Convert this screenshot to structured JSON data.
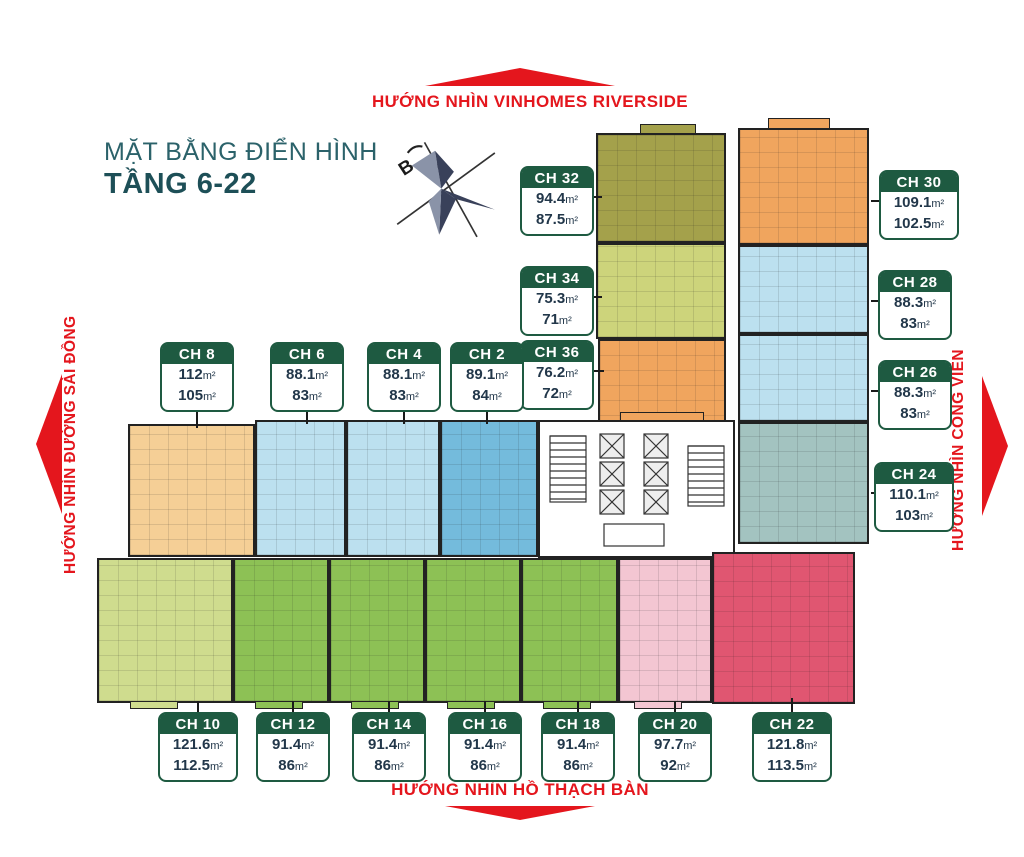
{
  "page": {
    "title_line1": "MẶT BẰNG ĐIỂN HÌNH",
    "title_line2": "TẦNG 6-22"
  },
  "directions": {
    "top": "HƯỚNG NHÌN VINHOMES RIVERSIDE",
    "bottom": "HƯỚNG NHÌN HỒ THẠCH BÀN",
    "left": "HƯỚNG NHÌN ĐƯỜNG SÀI ĐỒNG",
    "right": "HƯỚNG NHÌN CÔNG VIÊN"
  },
  "compass": {
    "label": "B"
  },
  "area_suffix": "m²",
  "units": [
    {
      "id": "ch-32",
      "label": "CH 32",
      "gross": "94.4",
      "net": "87.5"
    },
    {
      "id": "ch-30",
      "label": "CH 30",
      "gross": "109.1",
      "net": "102.5"
    },
    {
      "id": "ch-34",
      "label": "CH 34",
      "gross": "75.3",
      "net": "71"
    },
    {
      "id": "ch-28",
      "label": "CH 28",
      "gross": "88.3",
      "net": "83"
    },
    {
      "id": "ch-36",
      "label": "CH 36",
      "gross": "76.2",
      "net": "72"
    },
    {
      "id": "ch-26",
      "label": "CH 26",
      "gross": "88.3",
      "net": "83"
    },
    {
      "id": "ch-24",
      "label": "CH 24",
      "gross": "110.1",
      "net": "103"
    },
    {
      "id": "ch-8",
      "label": "CH 8",
      "gross": "112",
      "net": "105"
    },
    {
      "id": "ch-6",
      "label": "CH 6",
      "gross": "88.1",
      "net": "83"
    },
    {
      "id": "ch-4",
      "label": "CH 4",
      "gross": "88.1",
      "net": "83"
    },
    {
      "id": "ch-2",
      "label": "CH 2",
      "gross": "89.1",
      "net": "84"
    },
    {
      "id": "ch-10",
      "label": "CH 10",
      "gross": "121.6",
      "net": "112.5"
    },
    {
      "id": "ch-12",
      "label": "CH 12",
      "gross": "91.4",
      "net": "86"
    },
    {
      "id": "ch-14",
      "label": "CH 14",
      "gross": "91.4",
      "net": "86"
    },
    {
      "id": "ch-16",
      "label": "CH 16",
      "gross": "91.4",
      "net": "86"
    },
    {
      "id": "ch-18",
      "label": "CH 18",
      "gross": "91.4",
      "net": "86"
    },
    {
      "id": "ch-20",
      "label": "CH 20",
      "gross": "97.7",
      "net": "92"
    },
    {
      "id": "ch-22",
      "label": "CH 22",
      "gross": "121.8",
      "net": "113.5"
    }
  ],
  "colors": {
    "accent_red": "#e4161d",
    "title_teal": "#2b626a",
    "title_dark": "#1d4f57",
    "label_green": "#1e5a41",
    "number_navy": "#22374a",
    "blocks": {
      "olive": "#a4a14b",
      "orange": "#f0a55e",
      "lime": "#cdd47b",
      "lightblue": "#bce0ef",
      "blue": "#74bbdc",
      "teal": "#a3c3c0",
      "peach": "#f5cf96",
      "lightgreen": "#cfdc8e",
      "green": "#8dc155",
      "pink": "#f3c6d2",
      "crimson": "#e05671",
      "core": "#ffffff"
    }
  }
}
